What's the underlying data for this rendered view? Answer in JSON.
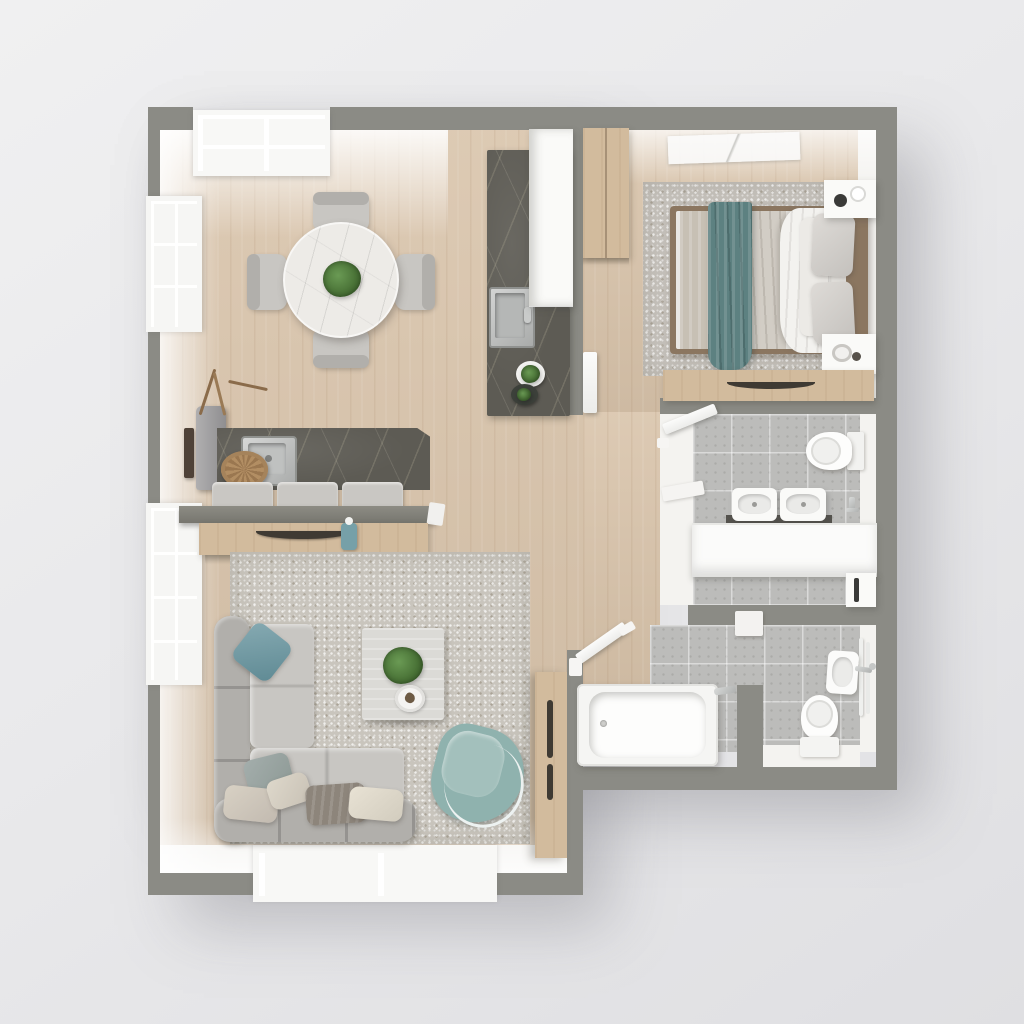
{
  "scene": {
    "description": "photorealistic top-down 3D floor plan render of a one-bedroom apartment",
    "view": "top-down orthographic",
    "no_visible_text": true
  },
  "palette": {
    "wall": "#8b8b85",
    "innerwall": "#f4f3f0",
    "woodfloor": "#d9c4ab",
    "woodfurn": "#d2bb9d",
    "tile": "#bcbcba",
    "rugliving": "#c9c5bd",
    "rugbedroom": "#c4c0ba",
    "marbledark": "#5d5b54",
    "marblewhite": "#edebe7",
    "sofa": "#bcbab6",
    "sofaback": "#b1afab",
    "cushion": "#c8c6c2",
    "teal": "#76a0a8",
    "tealdark": "#5d8181",
    "tealchair": "#8fb2ae",
    "whitefurn": "#fafaf8",
    "steel": "#b9bbba",
    "plant": "#4d7a3e",
    "headboard": "#8b7660",
    "handle": "#3f3a33",
    "taupe": "#8d857b",
    "beige": "#d6cfc2",
    "background": "#e9e9eb"
  },
  "rooms": [
    {
      "id": "dining-area",
      "furniture": [
        "round-marble-dining-table",
        "dining-chairs-x4",
        "potted-plant-centerpiece"
      ]
    },
    {
      "id": "kitchen",
      "furniture": [
        "dark-stone-counter",
        "inset-steel-sink-with-faucet",
        "tall-white-cabinet",
        "plant-bowls-x2"
      ]
    },
    {
      "id": "sideboard-nook",
      "furniture": [
        "dark-stone-top-sideboard",
        "inset-basin",
        "woven-basket",
        "seat-cushions-x3",
        "wood-drawer-front-with-handle",
        "gray-vase-with-dried-branches",
        "teal-bottle",
        "wall-mounted-dark-sconce"
      ]
    },
    {
      "id": "living-room",
      "furniture": [
        "l-shaped-sectional-sofa",
        "throw-pillows-x6",
        "square-coffee-table",
        "potted-plant",
        "round-decor-tray",
        "teal-armchair",
        "speckled-area-rug",
        "tall-wood-cabinet-with-handles"
      ]
    },
    {
      "id": "bedroom",
      "furniture": [
        "double-bed-with-white-duvet-and-teal-throw",
        "gray-pillows-x4",
        "wood-headboard",
        "white-nightstands-x2-with-decor",
        "wood-wardrobe",
        "wood-dresser-with-dark-handle",
        "area-rug",
        "ceiling-vent-panel"
      ]
    },
    {
      "id": "bathroom-main",
      "furniture": [
        "toilet-with-tank",
        "twin-countertop-basins",
        "dark-counter-edge",
        "white-vanity-unit",
        "wall-mounted-faucet",
        "white-storage-cabinet-with-handle",
        "swing-door-open",
        "wall-niche-shelf"
      ]
    },
    {
      "id": "bathroom-second",
      "furniture": [
        "bathtub-with-faucet",
        "toilet-with-tank",
        "wall-hung-sink-with-faucet",
        "towel-rail",
        "swing-door-open",
        "divider-wall-shelf"
      ]
    },
    {
      "id": "hallway",
      "furniture": [
        "white-swing-door-to-bedroom"
      ]
    }
  ],
  "windows": {
    "left_wall_windows": 2,
    "top_bay_window_panes": 4,
    "bottom_bay_window_panes": 2
  },
  "counts": {
    "dining_chairs": 4,
    "bathroom_basins": 2,
    "toilets": 2,
    "sofa_pillows": 6,
    "bed_pillows": 4
  }
}
